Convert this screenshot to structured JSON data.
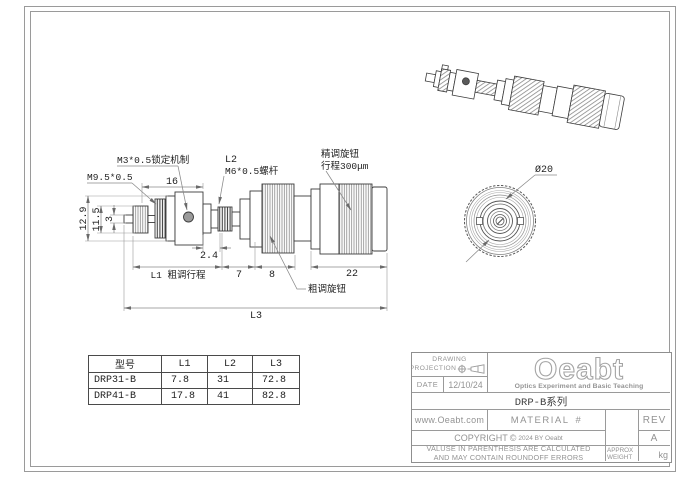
{
  "colors": {
    "part_line": "#3c3c3c",
    "dim_line": "#8a8a8a",
    "cad_text": "#1f1f1f",
    "frame": "#9a9a9a",
    "title_text": "#939393",
    "logo_outline": "#a4a4a4"
  },
  "side_view": {
    "labels": {
      "lock_mechanism": "M3*0.5锁定机制",
      "thread_left": "M9.5*0.5",
      "dim_16": "16",
      "l2": "L2",
      "screw": "M6*0.5螺杆",
      "fine_knob_1": "精调旋钮",
      "fine_knob_2": "行程300μm",
      "dim_12_9": "12.9",
      "dim_11_5": "11.5",
      "dim_3": "3",
      "dim_2_4": "2.4",
      "l1": "L1 粗调行程",
      "dim_7": "7",
      "dim_8": "8",
      "dim_22": "22",
      "coarse_knob": "粗调旋钮",
      "l3": "L3"
    }
  },
  "front_view": {
    "diameter": "Ø20"
  },
  "spec_table": {
    "headers": [
      "型号",
      "L1",
      "L2",
      "L3"
    ],
    "rows": [
      [
        "DRP31-B",
        "7.8",
        "31",
        "72.8"
      ],
      [
        "DRP41-B",
        "17.8",
        "41",
        "82.8"
      ]
    ]
  },
  "title_block": {
    "projection_label_1": "DRAWING",
    "projection_label_2": "PROJECTION",
    "date_label": "DATE",
    "date_value": "12/10/24",
    "logo_text": "Oeabt",
    "logo_tagline": "Optics Experiment and Basic Teaching",
    "series": "DRP-B系列",
    "website": "www.Oeabt.com",
    "material_label": "MATERIAL",
    "material_symbol": "#",
    "rev_label": "REV",
    "rev_value": "A",
    "copyright_pre": "COPYRIGHT",
    "copyright_symbol": "©",
    "copyright_post": "2024 BY Oeabt",
    "disclaimer_1": "VALUSE IN PARENTHESIS ARE CALCULATED",
    "disclaimer_2": "AND MAY CONTAIN ROUNDOFF ERRORS",
    "weight_label_1": "APPROX",
    "weight_label_2": "WEIGHT",
    "weight_unit": "kg"
  }
}
